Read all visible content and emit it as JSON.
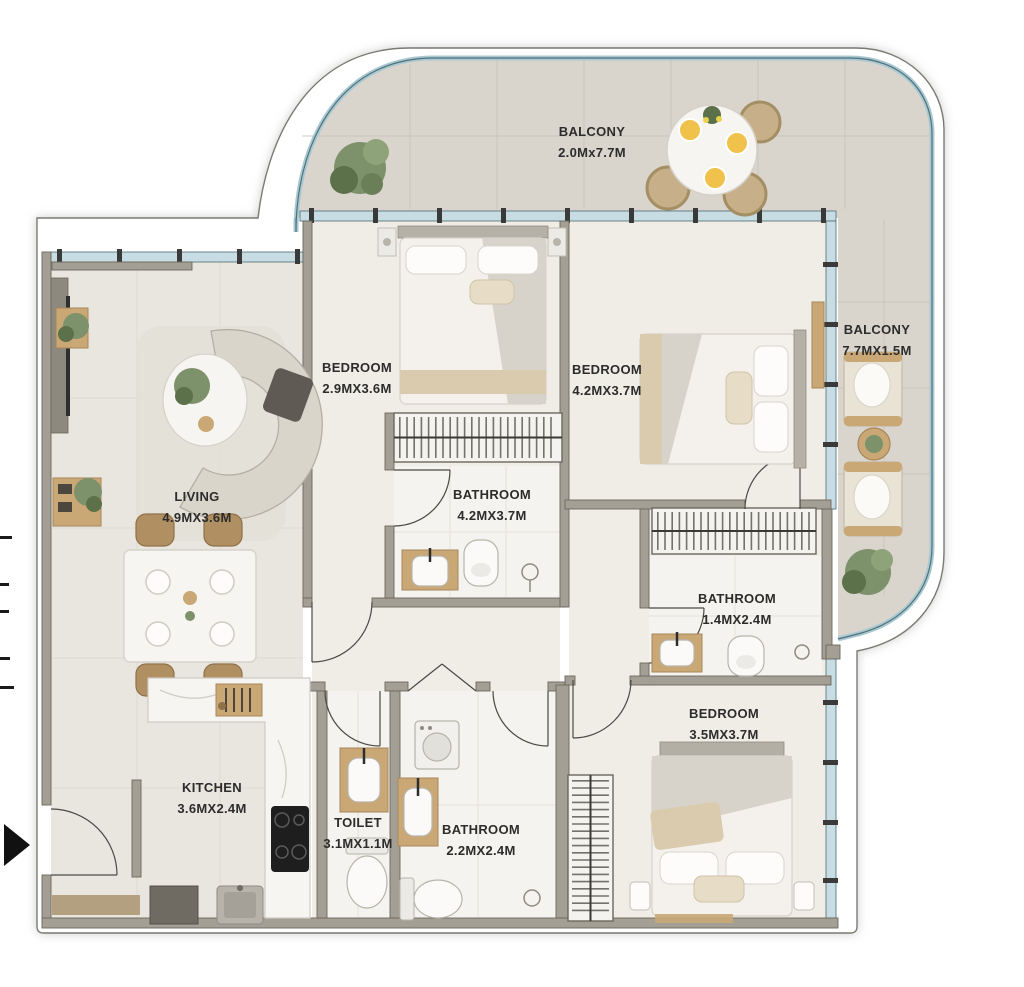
{
  "rooms": [
    {
      "id": "balcony-top",
      "name": "BALCONY",
      "dims": "2.0Mx7.7M"
    },
    {
      "id": "balcony-right",
      "name": "BALCONY",
      "dims": "7.7MX1.5M"
    },
    {
      "id": "bedroom-1",
      "name": "BEDROOM",
      "dims": "2.9MX3.6M"
    },
    {
      "id": "bedroom-2",
      "name": "BEDROOM",
      "dims": "4.2MX3.7M"
    },
    {
      "id": "bathroom-1",
      "name": "BATHROOM",
      "dims": "4.2MX3.7M"
    },
    {
      "id": "bathroom-2",
      "name": "BATHROOM",
      "dims": "1.4MX2.4M"
    },
    {
      "id": "living",
      "name": "LIVING",
      "dims": "4.9MX3.6M"
    },
    {
      "id": "kitchen",
      "name": "KITCHEN",
      "dims": "3.6MX2.4M"
    },
    {
      "id": "toilet",
      "name": "TOILET",
      "dims": "3.1MX1.1M"
    },
    {
      "id": "bathroom-3",
      "name": "BATHROOM",
      "dims": "2.2MX2.4M"
    },
    {
      "id": "bedroom-3",
      "name": "BEDROOM",
      "dims": "3.5MX3.7M"
    }
  ],
  "icons": {
    "entrance_arrow": "right-arrow"
  },
  "colors": {
    "glass": "#c8dde3",
    "glass_line": "#4a6a74",
    "railing": "#a9c9d2",
    "wall": "#a39f95",
    "wall_edge": "#6b675d",
    "balcony_floor": "#d9d5cd",
    "interior_floor": "#f0ede6",
    "living_floor": "#e9e6df",
    "bath_floor": "#f5f3ef",
    "text": "#2c2c2c",
    "wood": "#c9a876",
    "rattan": "#c7b089",
    "plant": "#7d916b",
    "plant_dark": "#5c7049",
    "arrow": "#111111",
    "stove": "#1e1e1e"
  }
}
